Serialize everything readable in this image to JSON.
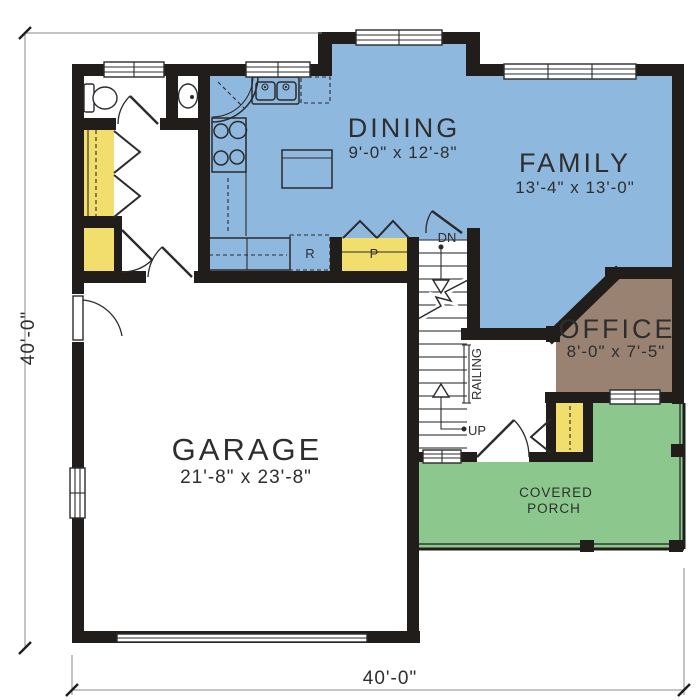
{
  "plan": {
    "rooms": {
      "dining": {
        "label": "DINING",
        "dims": "9'-0\" x 12'-8\""
      },
      "family": {
        "label": "FAMILY",
        "dims": "13'-4\" x 13'-0\""
      },
      "office": {
        "label": "OFFICE",
        "dims": "8'-0\" x 7'-5\""
      },
      "garage": {
        "label": "GARAGE",
        "dims": "21'-8\" x 23'-8\""
      },
      "covered_porch": {
        "label_line1": "COVERED",
        "label_line2": "PORCH"
      }
    },
    "annotations": {
      "refrigerator": "R",
      "pantry": "P",
      "stairs_down": "DN",
      "stairs_up": "UP",
      "railing": "RAILING"
    },
    "dimensions": {
      "left_total": "40'-0\"",
      "bottom_total": "40'-0\""
    },
    "colors": {
      "living_areas": "#8FB8DE",
      "closets": "#F2DE6C",
      "office": "#9A8273",
      "porch": "#8CC88D",
      "walls": "#211D1A"
    }
  }
}
